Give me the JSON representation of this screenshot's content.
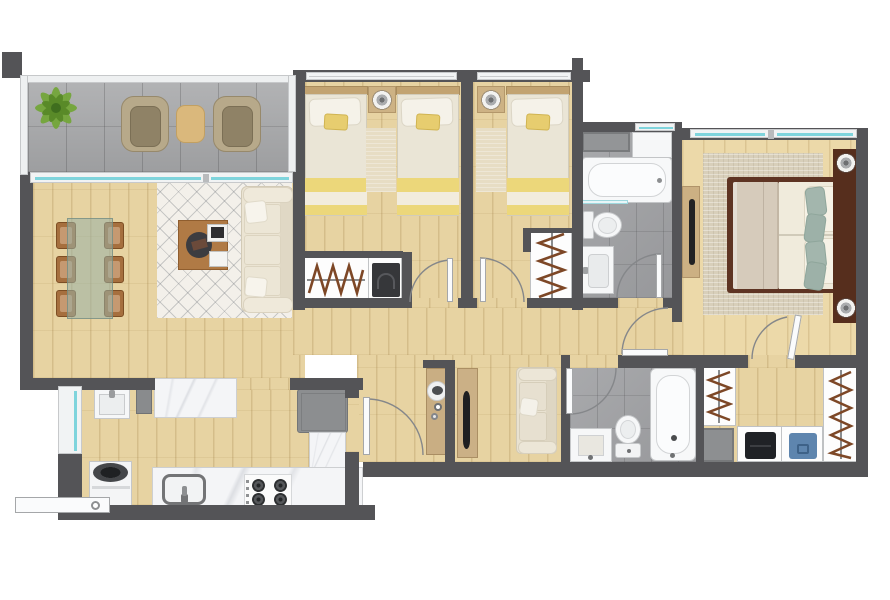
{
  "meta": {
    "type": "apartment-floor-plan",
    "view": "top-down-3d-render",
    "visible_text": "none",
    "canvas": {
      "width": 890,
      "height": 600
    }
  },
  "palette": {
    "wall": "#545457",
    "wood_floor": "#e7d3a2",
    "wood_floor_master": "#ecd9a9",
    "balcony_tile": "#a7a8aa",
    "bathroom_tile": "#9fa0a3",
    "fixture_white": "#f6f7f8",
    "countertop_marble": "#f4f5f7",
    "window_glass": "#7fd4dc",
    "blanket_yellow": "#ecd77a",
    "master_bed_frame": "#5e3423",
    "cushion_sage": "#a3b6ad",
    "sofa_cream": "#ebe4d3",
    "furniture_wood": "#cdb284",
    "dining_chair_wood": "#a66f3e",
    "living_rug": "#f3f0ea",
    "master_rug": "#d8cfba",
    "hanger_brown": "#7d4726",
    "appliance_gray": "#8c8e90",
    "plant_green": "#74a63a",
    "folded_denim": "#5e85ae",
    "folded_dark": "#202226"
  },
  "rooms": [
    {
      "id": "balcony",
      "label": "balcony-terrace",
      "furniture": [
        "potted-plant",
        "wicker-armchair",
        "wicker-armchair",
        "side-table"
      ]
    },
    {
      "id": "living-dining",
      "label": "living-dining-room",
      "furniture": [
        "glass-dining-table",
        "dining-chair-x6",
        "trellis-rug",
        "coffee-table",
        "tray",
        "books",
        "three-seat-sofa",
        "throw-pillows"
      ]
    },
    {
      "id": "kitchen-laundry",
      "label": "kitchen-and-laundry",
      "furniture": [
        "laundry-sink",
        "tall-cabinet",
        "marble-island",
        "refrigerator",
        "l-shaped-counter",
        "kitchen-sink",
        "gas-stove-4-burner",
        "washing-machine",
        "entry-door-leaf"
      ]
    },
    {
      "id": "bedroom-1",
      "label": "bedroom-twin",
      "furniture": [
        "single-bed",
        "single-bed",
        "nightstand-with-lamp",
        "rug",
        "closet-with-hangers",
        "folded-dark-item"
      ]
    },
    {
      "id": "bedroom-2",
      "label": "bedroom-single",
      "furniture": [
        "single-bed",
        "nightstand-with-lamp",
        "rug",
        "closet-with-hangers"
      ]
    },
    {
      "id": "bathroom-1",
      "label": "bathroom-top",
      "furniture": [
        "storage-shelf",
        "white-cabinet",
        "bathtub",
        "glass-screen",
        "toilet",
        "vanity-sink"
      ]
    },
    {
      "id": "master-bedroom",
      "label": "master-bedroom",
      "furniture": [
        "double-bed",
        "headboard-with-side-tables",
        "lamp",
        "lamp",
        "sage-cushions",
        "woven-rug",
        "dresser-with-tv"
      ]
    },
    {
      "id": "hallway",
      "label": "hallway",
      "furniture": [
        "console-with-decor",
        "tv-cabinet"
      ]
    },
    {
      "id": "family-area",
      "label": "family-sitting-area",
      "furniture": [
        "loveseat-sofa"
      ]
    },
    {
      "id": "bathroom-2",
      "label": "bathroom-bottom",
      "furniture": [
        "vanity-sink",
        "toilet",
        "bathtub"
      ]
    },
    {
      "id": "walk-in-closet",
      "label": "walk-in-closet",
      "furniture": [
        "hanging-rack",
        "hanging-rack",
        "gray-bin",
        "shelf-with-folded-clothes-dark",
        "shelf-with-folded-clothes-denim"
      ]
    }
  ],
  "openings": {
    "windows": [
      "bedroom-1-top",
      "bedroom-2-top",
      "bathroom-1-top",
      "master-top-double",
      "kitchen-side-glass-door",
      "balcony-sliding-door"
    ],
    "doors": [
      "bedroom-1",
      "bedroom-2",
      "bathroom-1",
      "kitchen-passage",
      "bathroom-2",
      "corridor-suite",
      "master-to-closet",
      "entry"
    ]
  }
}
